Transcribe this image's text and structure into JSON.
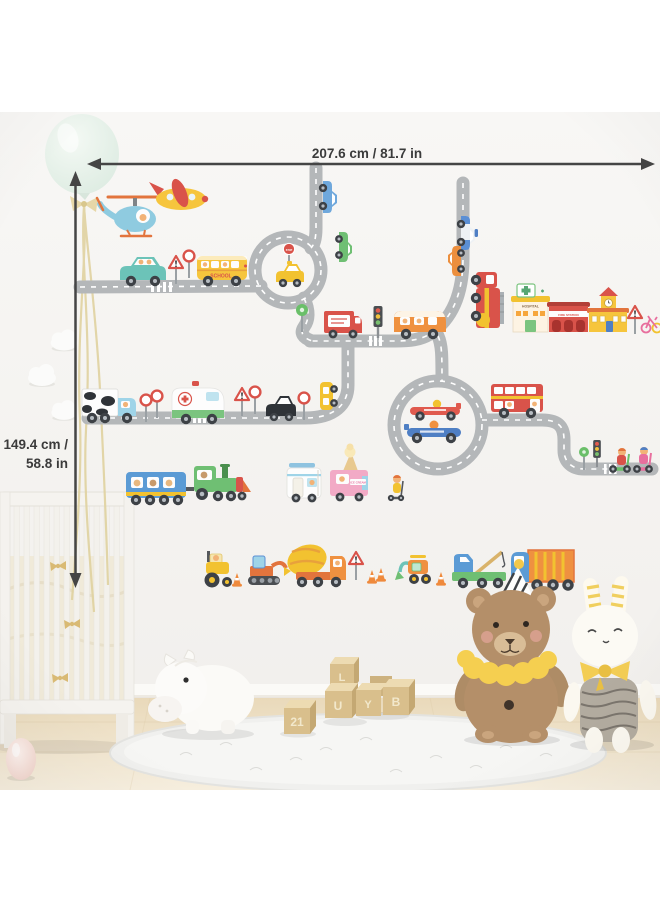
{
  "dimensions": {
    "width_label": "207.6 cm / 81.7 in",
    "height_line1": "149.4 cm /",
    "height_line2": "58.8 in"
  },
  "decal_texts": {
    "school_bus": "SCHOOL",
    "hospital": "HOSPITAL",
    "fire_station": "FIRE STATION",
    "ice_cream": "ICE CREAM",
    "stop_sign": "STOP"
  },
  "blocks": {
    "letters": [
      "21",
      "L",
      "U",
      "Y",
      "B"
    ]
  },
  "colors": {
    "road": "#b4b7b9",
    "road_line": "#ffffff",
    "dimension_line": "#454545",
    "wall": "#f5f4f1",
    "floor_wood": "#eadbbe",
    "bus_yellow": "#f6c53d",
    "fire_red": "#d9534a",
    "teal": "#6cc3b8",
    "orange": "#ef9140",
    "green": "#6fbf73",
    "blue": "#5b9bd5",
    "pink": "#f2aac6"
  },
  "stickers": [
    "helicopter",
    "airplane",
    "blue-car",
    "green-car",
    "family-car",
    "warning-signs",
    "school-bus",
    "roundabout-with-taxi",
    "stop-sign",
    "police-car",
    "orange-car",
    "fire-truck",
    "hospital-building",
    "fire-station-building",
    "clock-tower-building",
    "bicycle",
    "green-round-sign",
    "mail-truck",
    "traffic-light",
    "orange-van",
    "cow-milk-truck",
    "ambulance",
    "black-cab",
    "connector-car",
    "double-decker-bus",
    "roundabout-with-race-cars",
    "race-car-red",
    "race-car-blue",
    "scooter-riders",
    "toy-train",
    "camper-van",
    "ice-cream-truck",
    "kid-on-scooter",
    "tractor",
    "excavator",
    "cement-mixer",
    "mini-digger",
    "tow-truck",
    "dump-truck",
    "chick",
    "traffic-cones"
  ],
  "room_objects": [
    "mint-balloon",
    "paper-clouds",
    "white-crib",
    "hippo-toy",
    "wooden-letter-blocks",
    "teddy-bear-plush",
    "bunny-doll",
    "fluffy-rug",
    "egg-toy",
    "wood-floor"
  ]
}
